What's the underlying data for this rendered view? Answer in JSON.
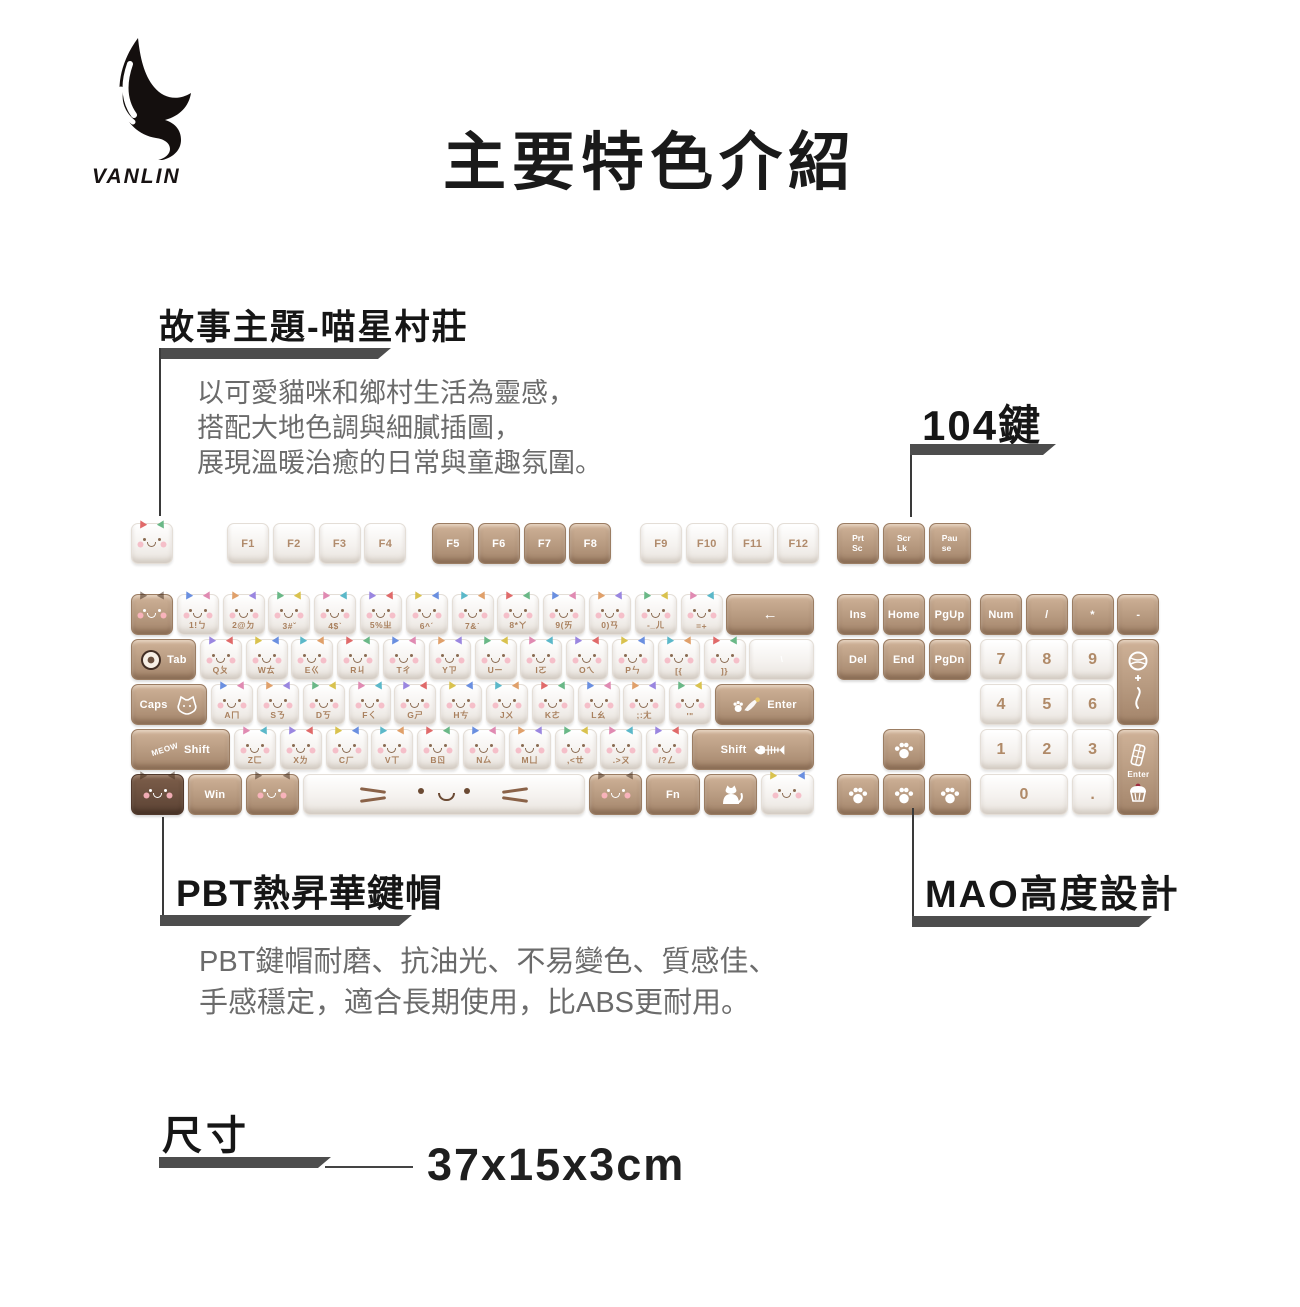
{
  "logo": {
    "brand": "VANLIN",
    "icon": "wing-logo"
  },
  "title": "主要特色介紹",
  "sections": {
    "story": {
      "heading": "故事主題-喵星村莊",
      "lines": [
        "以可愛貓咪和鄉村生活為靈感，",
        "搭配大地色調與細膩插圖，",
        "展現溫暖治癒的日常與童趣氛圍。"
      ]
    },
    "keys104": {
      "label": "104鍵"
    },
    "pbt": {
      "heading": "PBT熱昇華鍵帽",
      "lines": [
        "PBT鍵帽耐磨、抗油光、不易變色、質感佳、",
        "手感穩定，適合長期使用，比ABS更耐用。"
      ]
    },
    "mao": {
      "heading": "MAO高度設計"
    },
    "size": {
      "heading": "尺寸",
      "value": "37x15x3cm"
    }
  },
  "colors": {
    "callout_bar": "#4d4d4d",
    "heading_text": "#161616",
    "body_text": "#6b6b6b",
    "key_brown": "#b79a80",
    "key_brown_dark": "#6a4f3e",
    "key_white": "#f5f2ef",
    "legend_on_white": "#a9805e",
    "legend_on_brown": "#ffffff"
  },
  "keyboard": {
    "fn_groups": [
      {
        "x": 0,
        "keys": [
          {
            "t": "",
            "c": "w",
            "face": "b",
            "name": "esc"
          }
        ]
      },
      {
        "x": 96,
        "keys": [
          {
            "t": "F1",
            "c": "w",
            "lab": "c"
          },
          {
            "t": "F2",
            "c": "w",
            "lab": "c"
          },
          {
            "t": "F3",
            "c": "w",
            "lab": "c"
          },
          {
            "t": "F4",
            "c": "w",
            "lab": "c"
          }
        ]
      },
      {
        "x": 301,
        "keys": [
          {
            "t": "F5",
            "c": "b",
            "lab": "c"
          },
          {
            "t": "F6",
            "c": "b",
            "lab": "c"
          },
          {
            "t": "F7",
            "c": "b",
            "lab": "c"
          },
          {
            "t": "F8",
            "c": "b",
            "lab": "c"
          }
        ]
      },
      {
        "x": 509,
        "keys": [
          {
            "t": "F9",
            "c": "w",
            "lab": "c"
          },
          {
            "t": "F10",
            "c": "w",
            "lab": "c"
          },
          {
            "t": "F11",
            "c": "w",
            "lab": "c"
          },
          {
            "t": "F12",
            "c": "w",
            "lab": "c"
          }
        ]
      },
      {
        "x": 706,
        "keys": [
          {
            "t": "Prt|Sc",
            "c": "b",
            "name": "print-screen"
          },
          {
            "t": "Scr|Lk",
            "c": "b",
            "name": "scroll-lock"
          },
          {
            "t": "Pau|se",
            "c": "b",
            "name": "pause"
          }
        ]
      }
    ],
    "main_rows": [
      [
        {
          "t": "",
          "c": "b",
          "face": "w",
          "name": "backquote"
        },
        {
          "t": "1!ㄅ",
          "c": "w",
          "face": "b"
        },
        {
          "t": "2@ㄉ",
          "c": "w",
          "face": "b"
        },
        {
          "t": "3#ˇ",
          "c": "w",
          "face": "b"
        },
        {
          "t": "4$ˋ",
          "c": "w",
          "face": "b"
        },
        {
          "t": "5%ㄓ",
          "c": "w",
          "face": "b"
        },
        {
          "t": "6^ˊ",
          "c": "w",
          "face": "b"
        },
        {
          "t": "7&˙",
          "c": "w",
          "face": "b"
        },
        {
          "t": "8*ㄚ",
          "c": "w",
          "face": "b"
        },
        {
          "t": "9(ㄞ",
          "c": "w",
          "face": "b"
        },
        {
          "t": "0)ㄢ",
          "c": "w",
          "face": "b"
        },
        {
          "t": "-_ㄦ",
          "c": "w",
          "face": "b",
          "name": "minus"
        },
        {
          "t": "=+",
          "c": "w",
          "face": "b",
          "name": "equals"
        },
        {
          "t": "←",
          "c": "b",
          "w": 2,
          "lab": "c",
          "name": "backspace"
        }
      ],
      [
        {
          "t": "Tab",
          "c": "b",
          "w": 1.5,
          "icon": "donut",
          "name": "tab"
        },
        {
          "t": "Qㄆ",
          "c": "w",
          "face": "b"
        },
        {
          "t": "Wㄊ",
          "c": "w",
          "face": "b"
        },
        {
          "t": "Eㄍ",
          "c": "w",
          "face": "b"
        },
        {
          "t": "Rㄐ",
          "c": "w",
          "face": "b"
        },
        {
          "t": "Tㄔ",
          "c": "w",
          "face": "b"
        },
        {
          "t": "Yㄗ",
          "c": "w",
          "face": "b"
        },
        {
          "t": "Uㄧ",
          "c": "w",
          "face": "b"
        },
        {
          "t": "Iㄛ",
          "c": "w",
          "face": "b"
        },
        {
          "t": "Oㄟ",
          "c": "w",
          "face": "b"
        },
        {
          "t": "Pㄣ",
          "c": "w",
          "face": "b"
        },
        {
          "t": "[{",
          "c": "w",
          "face": "b",
          "name": "bracket-left"
        },
        {
          "t": "]}",
          "c": "w",
          "face": "b",
          "name": "bracket-right"
        },
        {
          "t": "\\|",
          "c": "w",
          "w": 1.5,
          "lab": "c",
          "name": "backslash"
        }
      ],
      [
        {
          "t": "Caps",
          "c": "b",
          "w": 1.75,
          "icon": "cat-outline",
          "name": "caps-lock"
        },
        {
          "t": "Aㄇ",
          "c": "w",
          "face": "b"
        },
        {
          "t": "Sㄋ",
          "c": "w",
          "face": "b"
        },
        {
          "t": "Dㄎ",
          "c": "w",
          "face": "b"
        },
        {
          "t": "Fㄑ",
          "c": "w",
          "face": "b"
        },
        {
          "t": "Gㄕ",
          "c": "w",
          "face": "b"
        },
        {
          "t": "Hㄘ",
          "c": "w",
          "face": "b"
        },
        {
          "t": "Jㄨ",
          "c": "w",
          "face": "b"
        },
        {
          "t": "Kㄜ",
          "c": "w",
          "face": "b"
        },
        {
          "t": "Lㄠ",
          "c": "w",
          "face": "b"
        },
        {
          "t": ";:ㄤ",
          "c": "w",
          "face": "b",
          "name": "semicolon"
        },
        {
          "t": "'\"",
          "c": "w",
          "face": "b",
          "name": "quote"
        },
        {
          "t": "Enter",
          "c": "b",
          "w": 2.25,
          "icon": "paw-feather",
          "name": "enter"
        }
      ],
      [
        {
          "t": "Shift",
          "c": "b",
          "w": 2.25,
          "icon": "meow",
          "name": "left-shift"
        },
        {
          "t": "Zㄈ",
          "c": "w",
          "face": "b"
        },
        {
          "t": "Xㄌ",
          "c": "w",
          "face": "b"
        },
        {
          "t": "Cㄏ",
          "c": "w",
          "face": "b"
        },
        {
          "t": "Vㄒ",
          "c": "w",
          "face": "b"
        },
        {
          "t": "Bㄖ",
          "c": "w",
          "face": "b"
        },
        {
          "t": "Nㄙ",
          "c": "w",
          "face": "b"
        },
        {
          "t": "Mㄩ",
          "c": "w",
          "face": "b"
        },
        {
          "t": ",<ㄝ",
          "c": "w",
          "face": "b",
          "name": "comma"
        },
        {
          "t": ".>ㄡ",
          "c": "w",
          "face": "b",
          "name": "period"
        },
        {
          "t": "/?ㄥ",
          "c": "w",
          "face": "b",
          "name": "slash"
        },
        {
          "t": "Shift",
          "c": "b",
          "w": 2.75,
          "icon": "fishbone",
          "name": "right-shift"
        }
      ],
      [
        {
          "t": "",
          "c": "d",
          "face": "w",
          "w": 1.25,
          "name": "left-ctrl"
        },
        {
          "t": "Win",
          "c": "b",
          "w": 1.25,
          "lab": "c",
          "name": "win"
        },
        {
          "t": "",
          "c": "b",
          "face": "w",
          "w": 1.25,
          "name": "left-alt"
        },
        {
          "t": "",
          "c": "w",
          "w": 6.25,
          "icon": "bigface",
          "name": "space"
        },
        {
          "t": "",
          "c": "b",
          "face": "w",
          "w": 1.25,
          "name": "right-alt"
        },
        {
          "t": "Fn",
          "c": "b",
          "w": 1.25,
          "lab": "c",
          "name": "fn"
        },
        {
          "t": "",
          "c": "b",
          "w": 1.25,
          "icon": "cat-body",
          "name": "menu"
        },
        {
          "t": "",
          "c": "w",
          "face": "b",
          "w": 1.25,
          "name": "right-ctrl"
        }
      ]
    ],
    "nav_rows": [
      {
        "row": 1,
        "keys": [
          {
            "t": "Ins",
            "c": "b",
            "lab": "c",
            "name": "insert"
          },
          {
            "t": "Home",
            "c": "b",
            "lab": "c",
            "name": "home"
          },
          {
            "t": "PgUp",
            "c": "b",
            "lab": "c",
            "name": "page-up"
          }
        ]
      },
      {
        "row": 2,
        "keys": [
          {
            "t": "Del",
            "c": "b",
            "lab": "c",
            "name": "delete"
          },
          {
            "t": "End",
            "c": "b",
            "lab": "c",
            "name": "end"
          },
          {
            "t": "PgDn",
            "c": "b",
            "lab": "c",
            "name": "page-down"
          }
        ]
      },
      {
        "row": 4,
        "xoff": 1,
        "keys": [
          {
            "t": "",
            "c": "b",
            "icon": "paw",
            "name": "arrow-up"
          }
        ]
      },
      {
        "row": 5,
        "keys": [
          {
            "t": "",
            "c": "b",
            "icon": "paw",
            "name": "arrow-left"
          },
          {
            "t": "",
            "c": "b",
            "icon": "paw",
            "name": "arrow-down"
          },
          {
            "t": "",
            "c": "b",
            "icon": "paw",
            "name": "arrow-right"
          }
        ]
      }
    ],
    "num_rows": [
      {
        "row": 1,
        "keys": [
          {
            "t": "Num",
            "c": "b",
            "lab": "c",
            "name": "num-lock"
          },
          {
            "t": "/",
            "c": "b",
            "lab": "c",
            "name": "numpad-divide"
          },
          {
            "t": "*",
            "c": "b",
            "lab": "c",
            "name": "numpad-multiply"
          },
          {
            "t": "-",
            "c": "b",
            "lab": "c",
            "name": "numpad-minus"
          }
        ]
      },
      {
        "row": 2,
        "keys": [
          {
            "t": "7",
            "c": "w",
            "lab": "num"
          },
          {
            "t": "8",
            "c": "w",
            "lab": "num"
          },
          {
            "t": "9",
            "c": "w",
            "lab": "num"
          },
          {
            "t": "",
            "c": "b",
            "h": 2,
            "icon": "yarn",
            "name": "numpad-plus"
          }
        ]
      },
      {
        "row": 3,
        "keys": [
          {
            "t": "4",
            "c": "w",
            "lab": "num"
          },
          {
            "t": "5",
            "c": "w",
            "lab": "num"
          },
          {
            "t": "6",
            "c": "w",
            "lab": "num"
          }
        ]
      },
      {
        "row": 4,
        "keys": [
          {
            "t": "1",
            "c": "w",
            "lab": "num"
          },
          {
            "t": "2",
            "c": "w",
            "lab": "num"
          },
          {
            "t": "3",
            "c": "w",
            "lab": "num"
          },
          {
            "t": "Enter",
            "c": "b",
            "h": 2,
            "icon": "dessert",
            "name": "numpad-enter"
          }
        ]
      },
      {
        "row": 5,
        "keys": [
          {
            "t": "0",
            "c": "w",
            "w": 2,
            "lab": "num"
          },
          {
            "t": ".",
            "c": "w",
            "lab": "num",
            "name": "numpad-dot"
          }
        ]
      }
    ]
  }
}
